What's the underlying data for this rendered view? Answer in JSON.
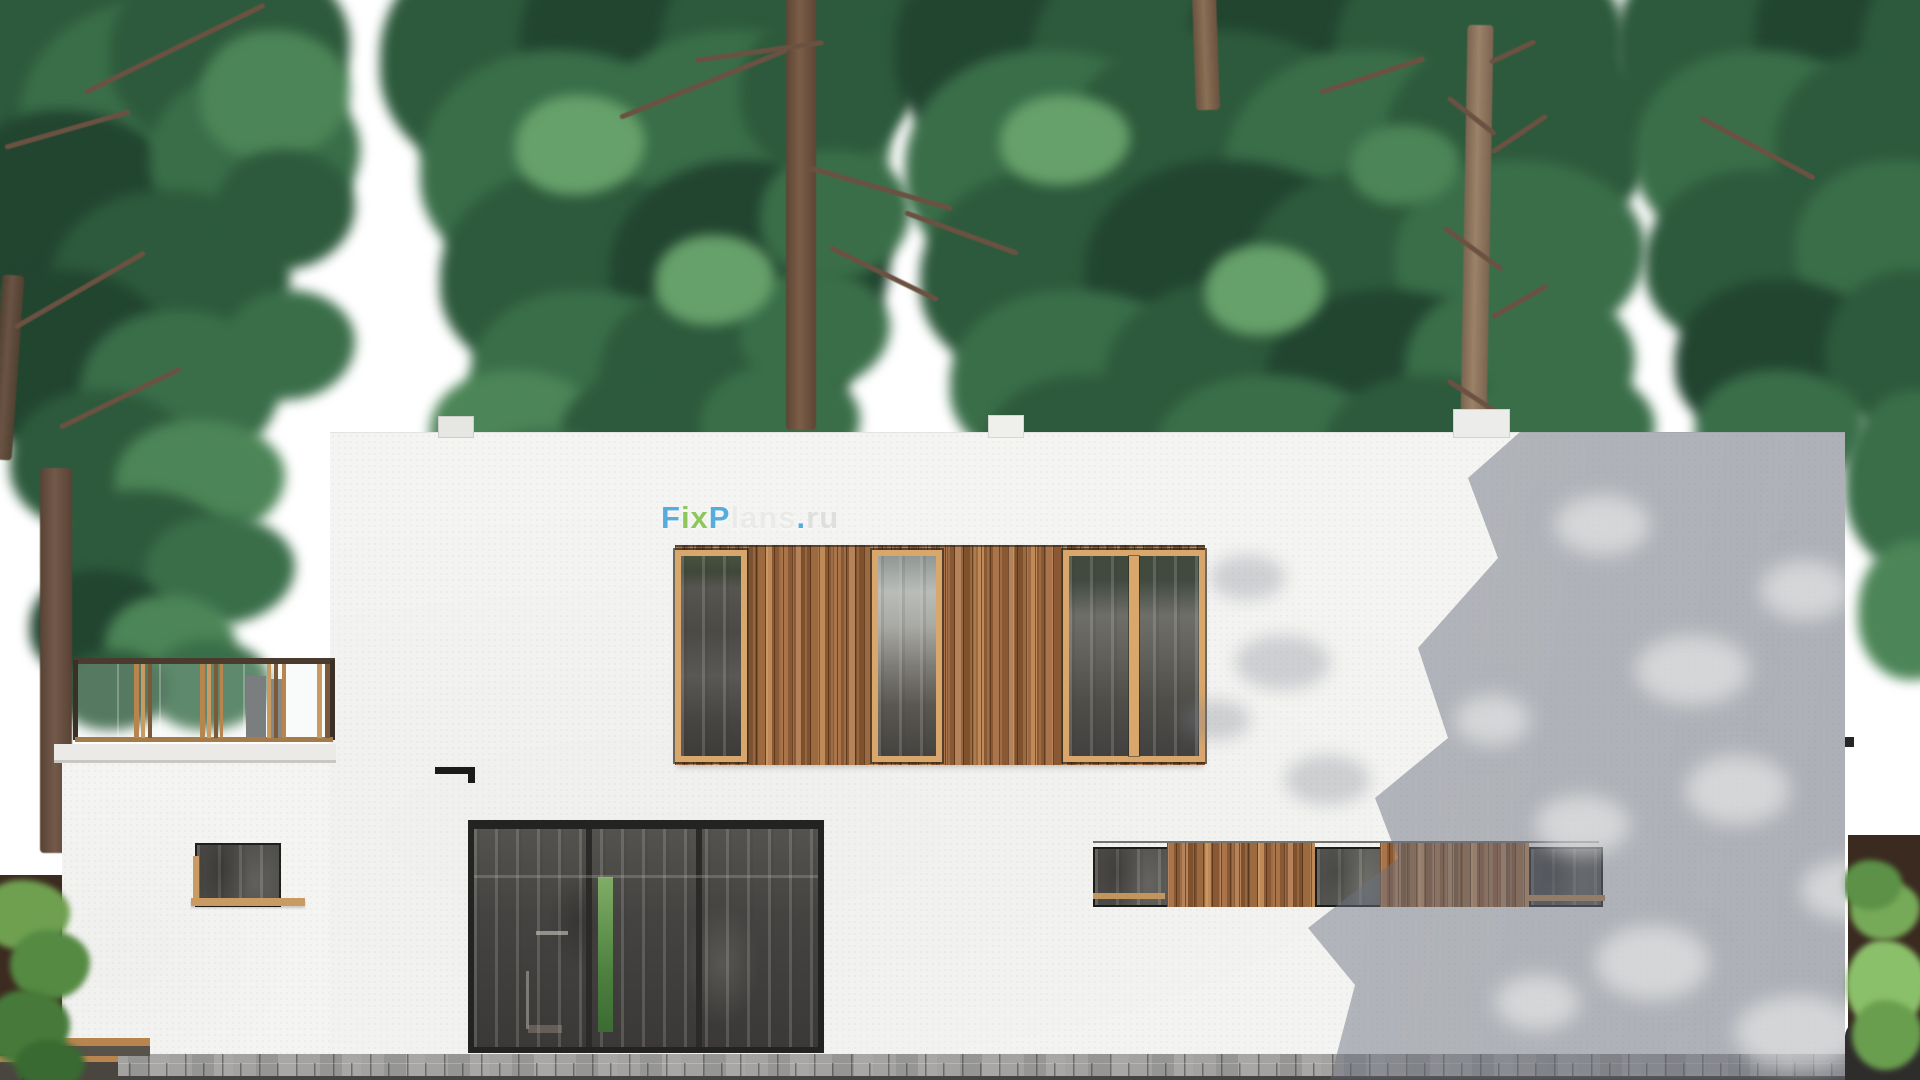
{
  "watermark": {
    "text": "FixPlans.ru",
    "segments": [
      {
        "text": "F",
        "color": "#3aa0dc"
      },
      {
        "text": "ix",
        "color": "#7cc143"
      },
      {
        "text": "P",
        "color": "#3aa0dc"
      },
      {
        "text": "lans",
        "color": "#e9e9e7"
      },
      {
        "text": ".",
        "color": "#3aa0dc"
      },
      {
        "text": "ru",
        "color": "#dcdcda"
      }
    ]
  },
  "scene": {
    "type": "architectural elevation render",
    "palette": {
      "sky": "#ffffff",
      "wall": "#f4f4f2",
      "wood_frame": "#d9a76c",
      "wood_slats": "#9a683c",
      "glass_dark": "#4a4846",
      "foliage_dark": "#2d5a3c",
      "foliage_light": "#66a06a",
      "facade_shadow": "#767c86",
      "pavers": "#a3a2a0",
      "fence": "#3c2b20"
    }
  }
}
